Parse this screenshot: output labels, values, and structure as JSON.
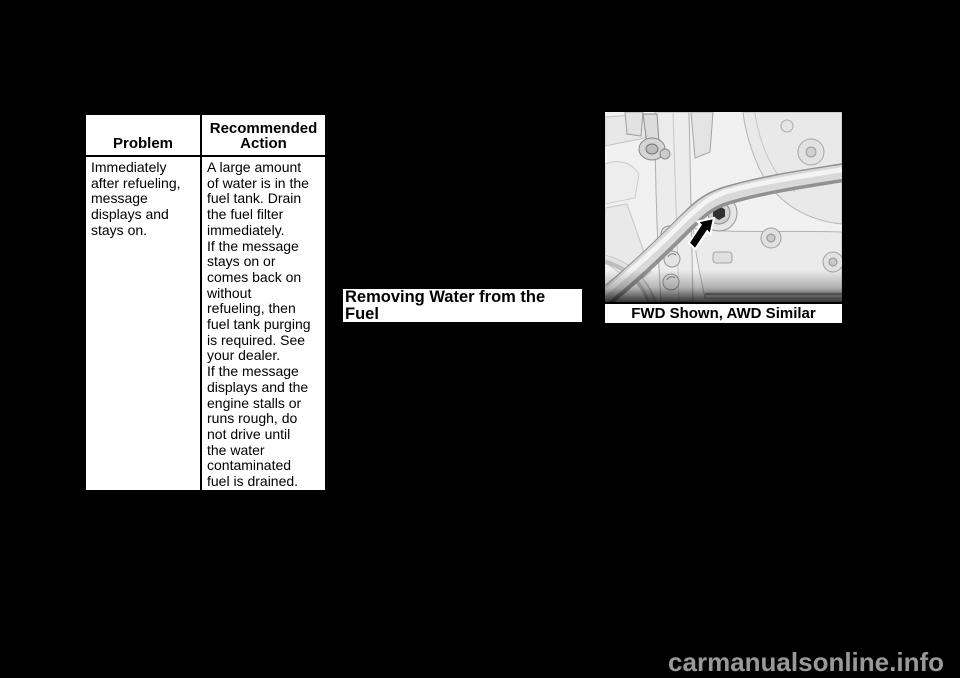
{
  "page": {
    "background": "#000000"
  },
  "table": {
    "header": {
      "problem": "Problem",
      "action": "Recommended\nAction"
    },
    "row": {
      "problem": "Immediately\nafter refueling,\nmessage\ndisplays and\nstays on.",
      "action": "A large amount\nof water is in the\nfuel tank. Drain\nthe fuel filter\nimmediately.\nIf the message\nstays on or\ncomes back on\nwithout\nrefueling, then\nfuel tank purging\nis required. See\nyour dealer.\nIf the message\ndisplays and the\nengine stalls or\nruns rough, do\nnot drive until\nthe water\ncontaminated\nfuel is drained."
    }
  },
  "section_heading": "Removing Water from the Fuel\nFilter",
  "figure": {
    "caption": "FWD Shown, AWD Similar",
    "illustration": "car-underbody-fuel-filter-drain-illustration"
  },
  "watermark": "carmanualsonline.info",
  "colors": {
    "page_bg": "#000000",
    "box_bg": "#ffffff",
    "text": "#000000",
    "border": "#000000",
    "watermark": "#999999",
    "illustration_bg": "#f1f1f1"
  }
}
